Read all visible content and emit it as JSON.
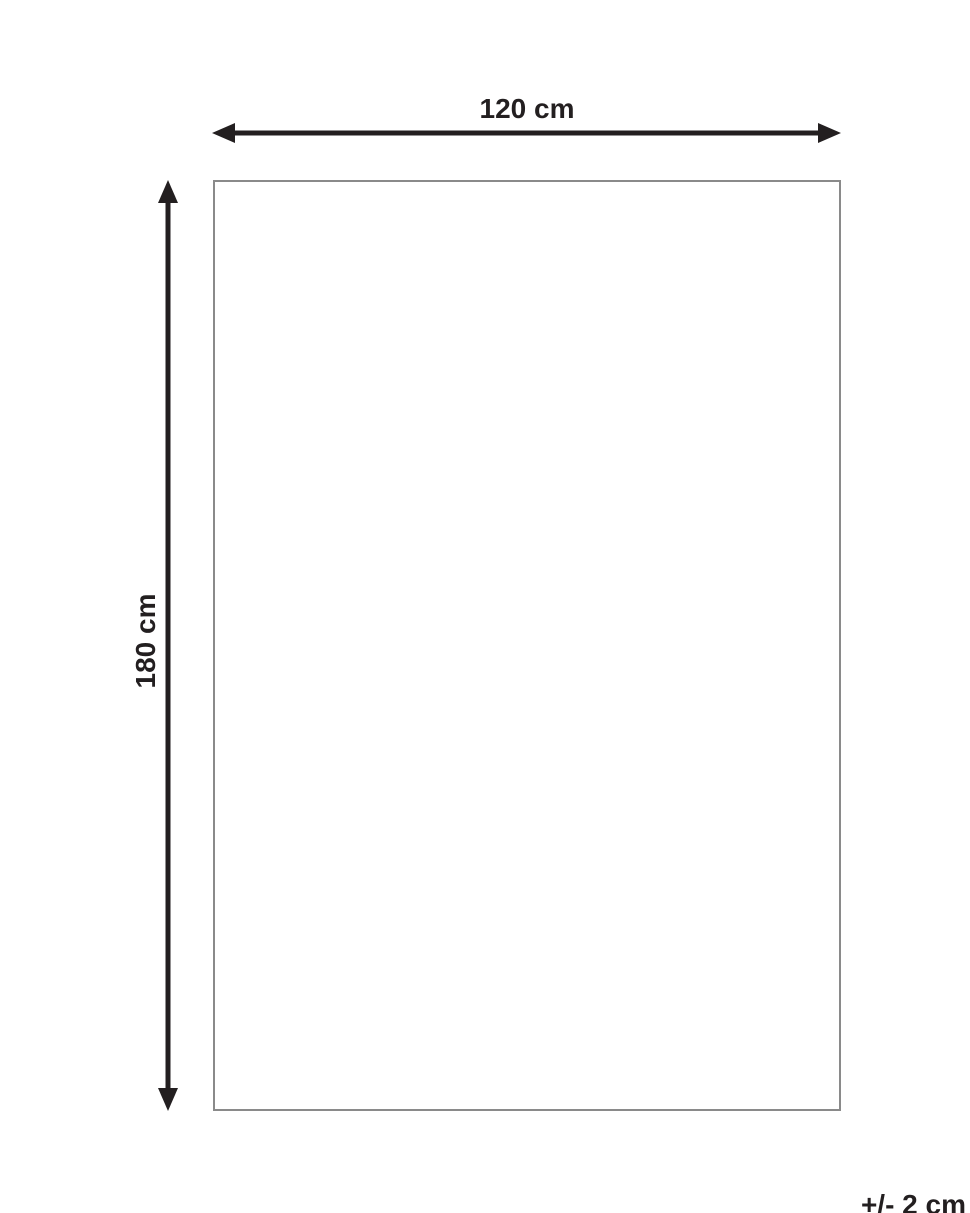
{
  "diagram": {
    "title_semantic": "product-dimension-diagram",
    "width_label": "120 cm",
    "height_label": "180 cm",
    "tolerance_label": "+/- 2 cm",
    "colors": {
      "arrow": "#231f20",
      "text": "#231f20",
      "rectangle_border": "#8a8a8a",
      "background": "#ffffff"
    }
  }
}
